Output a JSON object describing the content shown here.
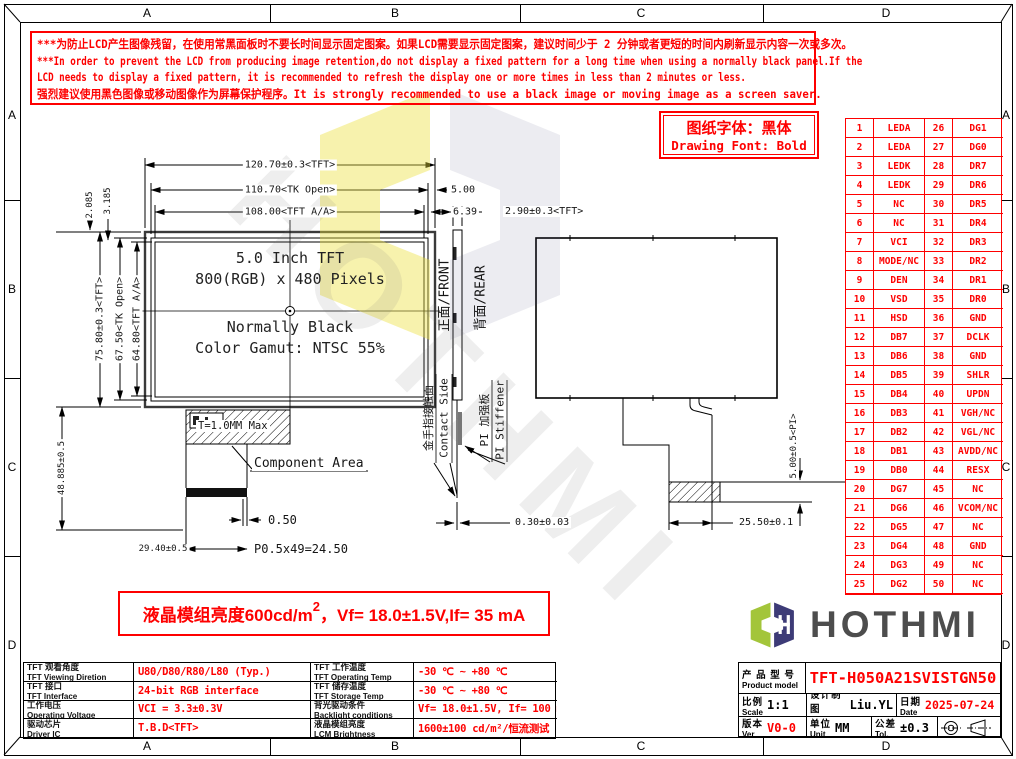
{
  "colors": {
    "red": "#fe0000",
    "ink": "#111111",
    "logo_green": "#a3c53a",
    "logo_navy": "#3d3b77",
    "logo_text": "#4d4d4d"
  },
  "frame": {
    "top_cols": [
      "A",
      "B",
      "C",
      "D"
    ],
    "bottom_cols": [
      "A",
      "B",
      "C",
      "D"
    ],
    "left_rows": [
      "A",
      "B",
      "C",
      "D"
    ],
    "right_rows": [
      "A",
      "B",
      "C",
      "D"
    ]
  },
  "warning": {
    "lines": [
      "***为防止LCD产生图像残留，在使用常黑面板时不要长时间显示固定图案。如果LCD需要显示固定图案，建议时间少于 2 分钟或者更短的时间内刷新显示内容一次或多次。",
      "***In order to prevent the LCD from producing image retention,do not display a fixed pattern for a long time when using a normally black panel.If the",
      " LCD needs to display a fixed pattern, it is recommended to refresh the display one or more times in less than 2 minutes or less.",
      "强烈建议使用黑色图像或移动图像作为屏幕保护程序。It is strongly recommended to use a black image or moving image as a screen saver."
    ]
  },
  "font_note": {
    "cn": "图纸字体：黑体",
    "en": "Drawing Font: Bold"
  },
  "pin_table": {
    "rows": [
      [
        "1",
        "LEDA",
        "26",
        "DG1"
      ],
      [
        "2",
        "LEDA",
        "27",
        "DG0"
      ],
      [
        "3",
        "LEDK",
        "28",
        "DR7"
      ],
      [
        "4",
        "LEDK",
        "29",
        "DR6"
      ],
      [
        "5",
        "NC",
        "30",
        "DR5"
      ],
      [
        "6",
        "NC",
        "31",
        "DR4"
      ],
      [
        "7",
        "VCI",
        "32",
        "DR3"
      ],
      [
        "8",
        "MODE/NC",
        "33",
        "DR2"
      ],
      [
        "9",
        "DEN",
        "34",
        "DR1"
      ],
      [
        "10",
        "VSD",
        "35",
        "DR0"
      ],
      [
        "11",
        "HSD",
        "36",
        "GND"
      ],
      [
        "12",
        "DB7",
        "37",
        "DCLK"
      ],
      [
        "13",
        "DB6",
        "38",
        "GND"
      ],
      [
        "14",
        "DB5",
        "39",
        "SHLR"
      ],
      [
        "15",
        "DB4",
        "40",
        "UPDN"
      ],
      [
        "16",
        "DB3",
        "41",
        "VGH/NC"
      ],
      [
        "17",
        "DB2",
        "42",
        "VGL/NC"
      ],
      [
        "18",
        "DB1",
        "43",
        "AVDD/NC"
      ],
      [
        "19",
        "DB0",
        "44",
        "RESX"
      ],
      [
        "20",
        "DG7",
        "45",
        "NC"
      ],
      [
        "21",
        "DG6",
        "46",
        "VCOM/NC"
      ],
      [
        "22",
        "DG5",
        "47",
        "NC"
      ],
      [
        "23",
        "DG4",
        "48",
        "GND"
      ],
      [
        "24",
        "DG3",
        "49",
        "NC"
      ],
      [
        "25",
        "DG2",
        "50",
        "NC"
      ]
    ]
  },
  "front_view": {
    "line1": "5.0 Inch TFT",
    "line2": "800(RGB) x 480 Pixels",
    "line3": "Normally Black",
    "line4": "Color Gamut: NTSC 55%"
  },
  "dimensions": {
    "width_tft": "120.70±0.3<TFT>",
    "width_tk_open": "110.70<TK Open>",
    "width_active": "108.00<TFT A/A>",
    "edge_gap_tk": "5.00",
    "edge_gap_active": "6.39",
    "corner_gap_small": "2.085",
    "corner_gap_large": "3.185",
    "height_tft": "75.80±0.3<TFT>",
    "height_tk_open": "67.50<TK Open>",
    "height_active": "64.80<TFT A/A>",
    "fpc_length": "48.885±0.5",
    "component_thickness": "T=1.0MM Max",
    "component_area_label": "Component Area",
    "pad_width": "0.50",
    "fpc_width": "29.40±0.5",
    "pad_pitch": "P0.5x49=24.50",
    "module_thickness": "2.90±0.3<TFT>",
    "fpc_thickness": "0.30±0.03",
    "tail_offset": "25.50±0.1",
    "stiffener_width": "5.00±0.5<PI>"
  },
  "side_labels": {
    "front": "正面/FRONT",
    "rear": "背面/REAR",
    "contact_cn": "金手指接触面",
    "contact_en": "Contact Side",
    "stiffener_cn": "PI 加强板",
    "stiffener_en": "PI Stiffener"
  },
  "brightness_note": {
    "prefix": "液晶模组亮度600cd/m",
    "sup": "2",
    "suffix": "，Vf= 18.0±1.5V,If= 35 mA"
  },
  "logo": {
    "text": "HOTHMI"
  },
  "watermark": {
    "text": "HOTHMI"
  },
  "title_block": {
    "product_label_cn": "产 品 型 号",
    "product_label_en": "Product model",
    "product_model": "TFT-H050A21SVISTGN50",
    "scale_cn": "比例",
    "scale_en": "Scale",
    "scale_value": "1:1",
    "design_cn": "设计制图",
    "design_en": "Design",
    "design_value": "Liu.YL",
    "date_cn": "日期",
    "date_en": "Date",
    "date_value": "2025-07-24",
    "ver_cn": "版本",
    "ver_en": "Ver",
    "ver_value": "V0-0",
    "unit_cn": "单位",
    "unit_en": "Unit",
    "unit_value": "MM",
    "tol_cn": "公差",
    "tol_en": "Tol.",
    "tol_value": "±0.3"
  },
  "spec_table": {
    "rows": [
      {
        "l1cn": "TFT 观看角度",
        "l1en": "TFT Viewing Diretion",
        "v1": "U80/D80/R80/L80 (Typ.)",
        "l2cn": "TFT 工作温度",
        "l2en": "TFT Operating Temp",
        "v2": "-30 ℃ ~ +80 ℃"
      },
      {
        "l1cn": "TFT 接口",
        "l1en": "TFT Interface",
        "v1": "24-bit RGB interface",
        "l2cn": "TFT 储存温度",
        "l2en": "TFT Storage Temp",
        "v2": "-30 ℃ ~ +80 ℃"
      },
      {
        "l1cn": "工作电压",
        "l1en": "Operating Voltage",
        "v1": "VCI = 3.3±0.3V",
        "l2cn": "背光驱动条件",
        "l2en": "Backlight conditions",
        "v2": "Vf= 18.0±1.5V, If= 100 mA"
      },
      {
        "l1cn": "驱动芯片",
        "l1en": "Driver IC",
        "v1": "T.B.D<TFT>",
        "l2cn": "液晶模组亮度",
        "l2en": "LCM Brightness",
        "v2": "1600±100 cd/m²/恒流测试"
      }
    ]
  }
}
